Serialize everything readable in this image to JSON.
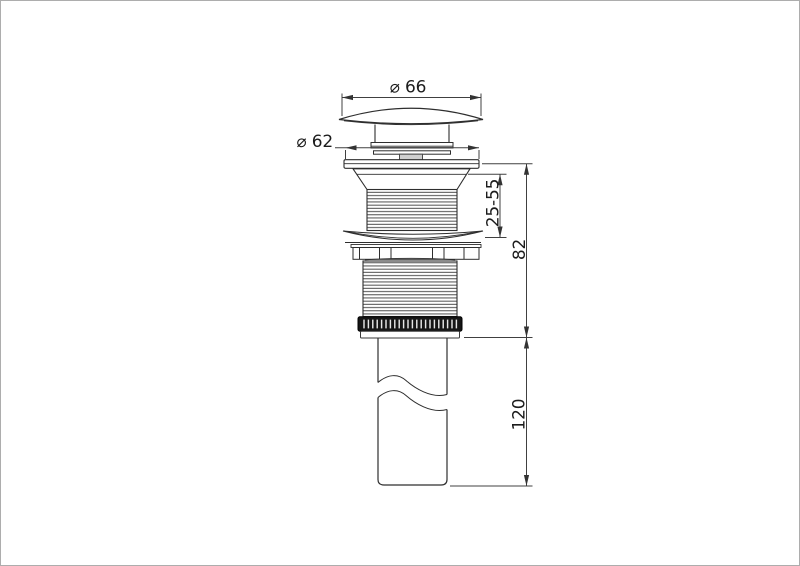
{
  "page": {
    "background": "#ffffff",
    "border_color": "#adadad"
  },
  "drawing": {
    "kind": "technical-dimension-drawing",
    "line_color": "#333333",
    "nut_fill": "#161616",
    "stem_fill": "#cfcfcf",
    "labels": {
      "cap_diameter": "⌀ 66",
      "flange_diameter": "⌀ 62",
      "thread_clamp_range": "25-55",
      "body_height": "82",
      "tailpipe_length": "120"
    }
  }
}
